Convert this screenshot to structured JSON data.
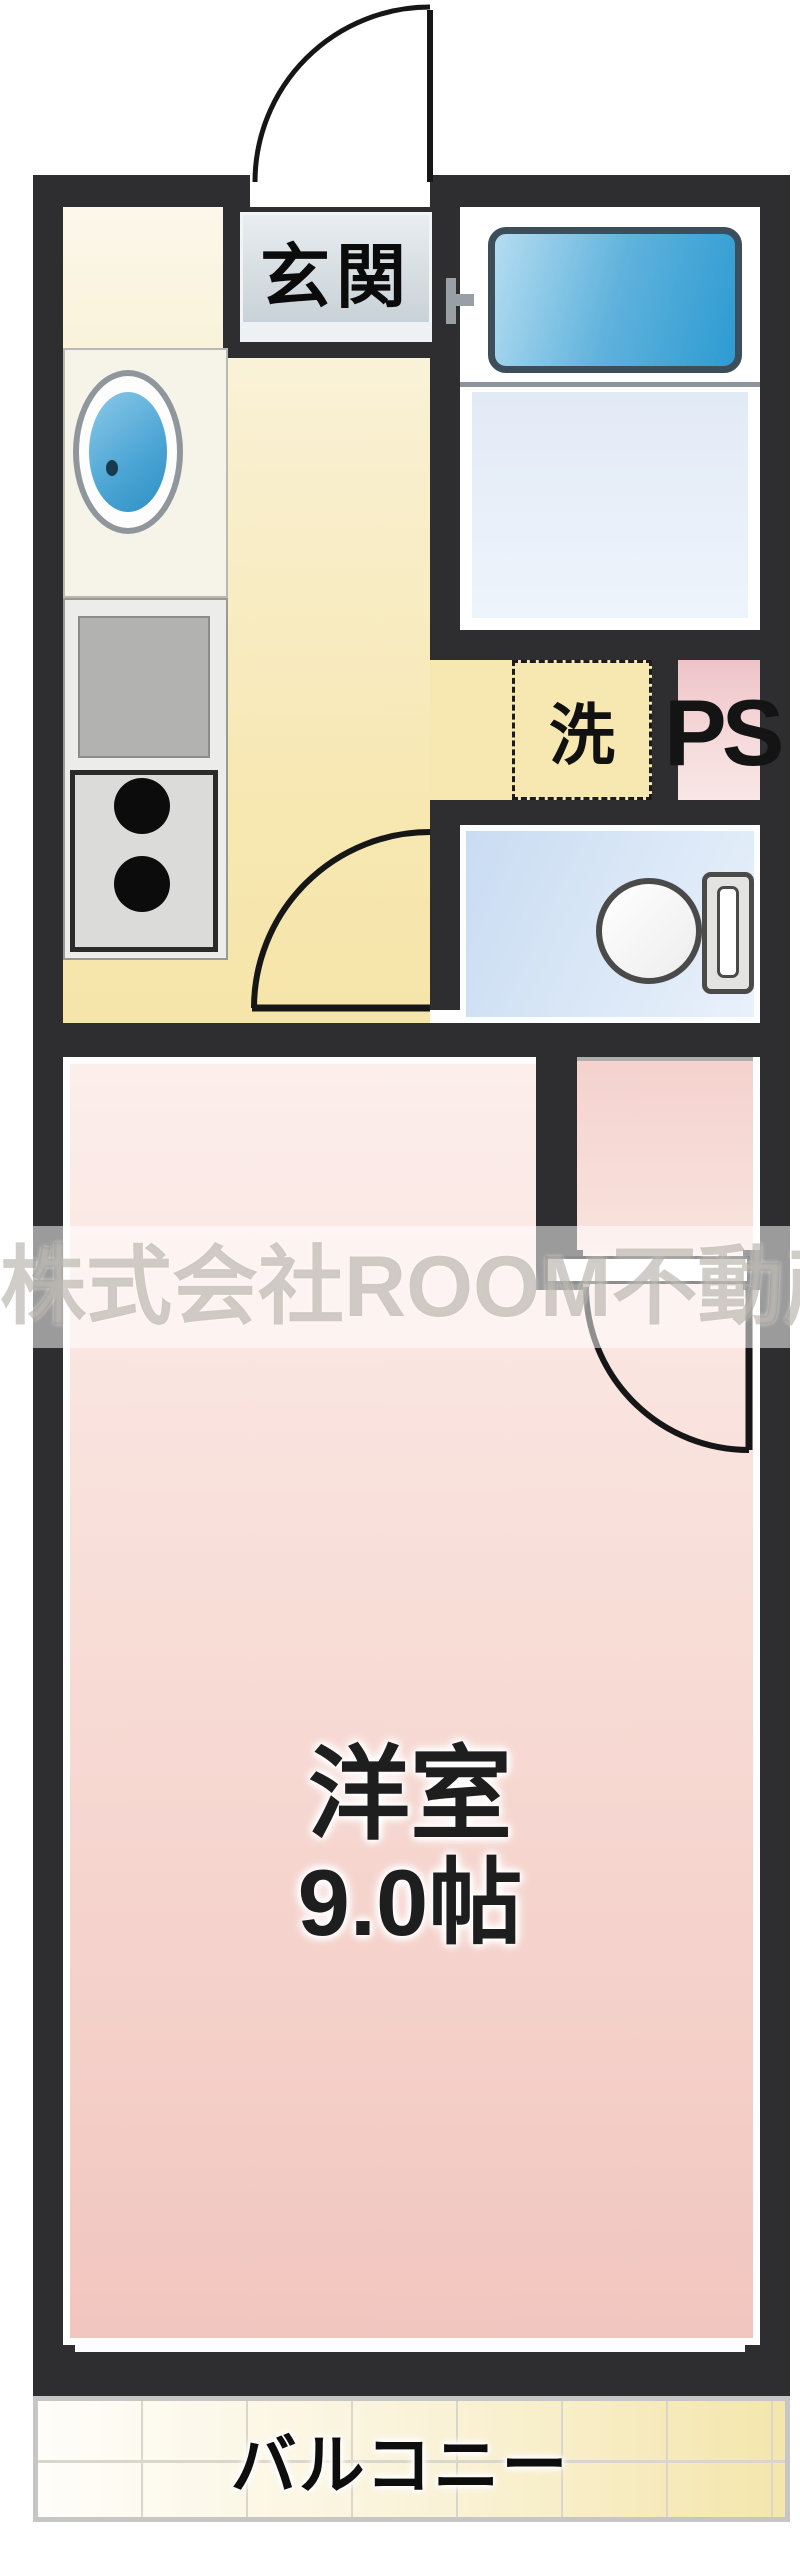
{
  "floorplan": {
    "type": "japanese-apartment-floor-plan",
    "labels": {
      "entrance": "玄関",
      "laundry": "洗",
      "pipe_space": "PS",
      "room_name": "洋室",
      "room_size": "9.0帖",
      "balcony": "バルコニー",
      "watermark": "株式会社ROOM不動産"
    },
    "colors": {
      "wall": "#2e2e30",
      "kitchen_floor": "#f7e8b4",
      "main_room_floor": "#f2c8c1",
      "alcove_floor": "#f4d2ce",
      "bath_floor": "#e2eaf6",
      "toilet_floor": "#c9dcf2",
      "bathtub": "#2d9bd2",
      "sink": "#2e8fc4",
      "ps_box": "#eec3c8",
      "genkan_floor": "#ccd5da",
      "balcony_tile": "#f4e6ac"
    }
  }
}
